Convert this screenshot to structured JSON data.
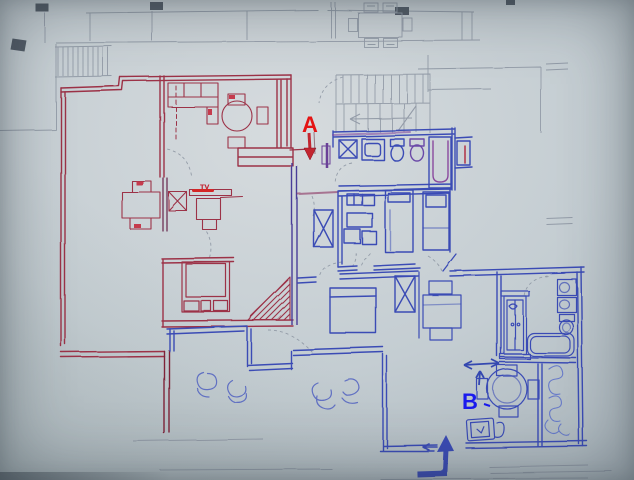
{
  "annotations": {
    "a": {
      "label": "A",
      "color": "#e41414"
    },
    "b": {
      "label": "B",
      "color": "#1a1aee"
    }
  },
  "handwriting": {
    "tv_label": "TV"
  },
  "palette": {
    "paper": "#c6ced2",
    "pencil": "#8a93a0",
    "red_ink": "#9c3147",
    "bright_red": "#c53a4e",
    "blue_ink": "#3a4cb5",
    "purple_ink": "#6b3f97",
    "annotation_red": "#e41414",
    "annotation_blue": "#1a1aee"
  }
}
